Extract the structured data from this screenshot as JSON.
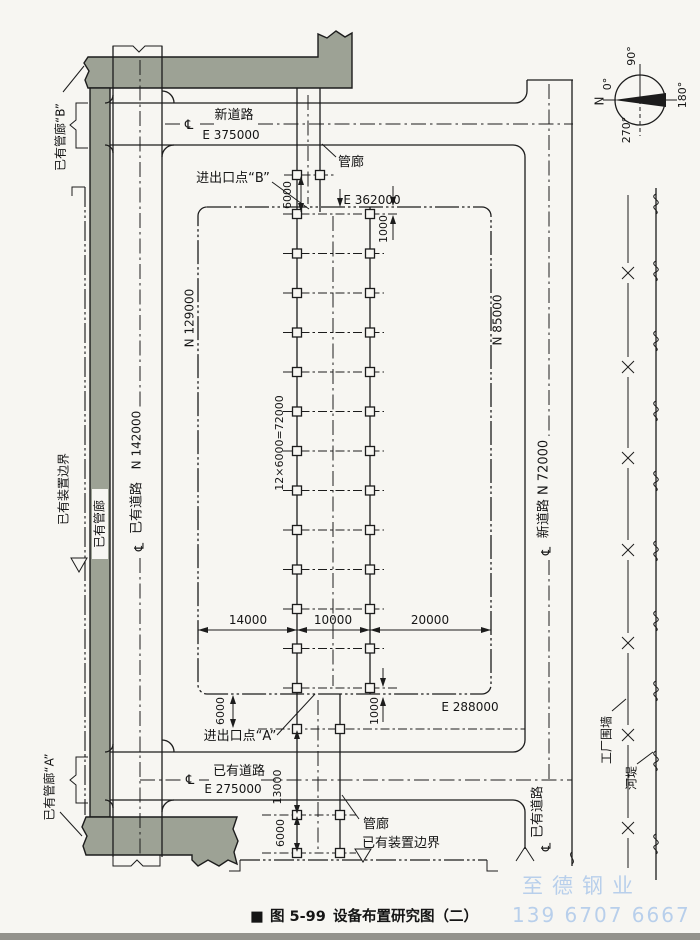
{
  "figure": {
    "marker": "■",
    "number": "图 5-99",
    "title": "设备布置研究图（二）"
  },
  "symbols": {
    "centerline": "℄"
  },
  "colors": {
    "paper": "#f7f6f2",
    "ink": "#1c1c1c",
    "band": "#9da295",
    "wm": "#a9c6ea"
  },
  "roads": {
    "top": {
      "name": "新道路",
      "coord": "E 375000"
    },
    "left": {
      "name": "已有道路",
      "coord": "N 142000"
    },
    "right": {
      "name": "新道路 N 72000"
    },
    "bottom": {
      "name": "已有道路",
      "coord": "E 275000"
    },
    "bottom_right": {
      "name": "已有道路"
    }
  },
  "plot": {
    "top": "E 362000",
    "bottom": "E 288000",
    "left": "N 129000",
    "right": "N 85000"
  },
  "existing": {
    "pipe_rack_b": "已有管廊“B”",
    "pipe_rack_a": "已有管廊“A”",
    "pipe_rack_left": "已有管廊",
    "unit_boundary_left": "已有装置边界",
    "unit_boundary_bottom": "已有装置边界"
  },
  "pipe_rack": {
    "label_top": "管廊",
    "label_bottom": "管廊"
  },
  "entries": {
    "b": "进出口点“B”",
    "a": "进出口点“A”"
  },
  "dims": {
    "top_6000": "6000",
    "top_1000": "1000",
    "bay": "12×6000=72000",
    "w14000": "14000",
    "w10000": "10000",
    "w20000": "20000",
    "bottom_6000_upper": "6000",
    "bottom_13000": "13000",
    "bottom_6000_lower": "6000",
    "bottom_1000": "1000"
  },
  "site": {
    "fence": "工厂围墙",
    "river": "河堤"
  },
  "compass": {
    "n": "N",
    "deg0": "0°",
    "deg90": "90°",
    "deg180": "180°",
    "deg270": "270°"
  },
  "watermark": {
    "line1": "至德钢业",
    "line2": "139 6707 6667"
  }
}
